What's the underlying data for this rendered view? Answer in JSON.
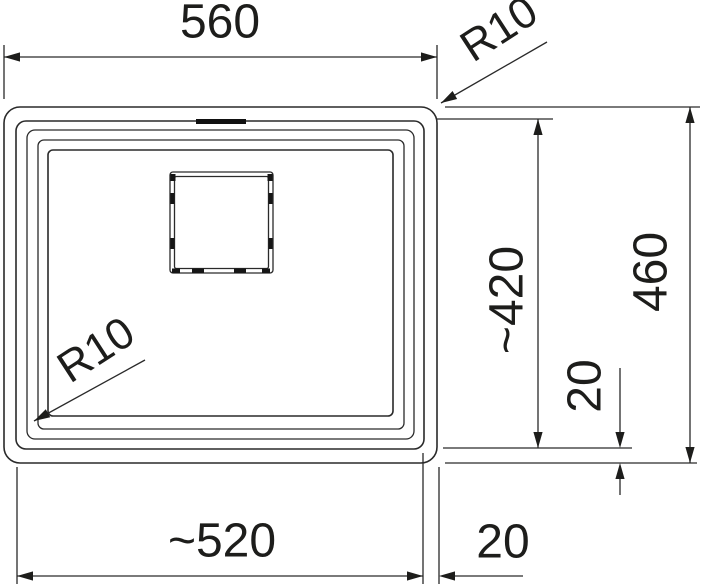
{
  "drawing": {
    "type": "sink-technical-drawing",
    "line_color": "#1d1d1b",
    "background_color": "#ffffff",
    "labels": {
      "width_overall": "560",
      "radius_top_right": "R10",
      "depth_overall": "460",
      "depth_bowl": "~420",
      "offset_right": "20",
      "width_bowl": "~520",
      "offset_bottom": "20",
      "radius_bowl": "R10"
    }
  }
}
